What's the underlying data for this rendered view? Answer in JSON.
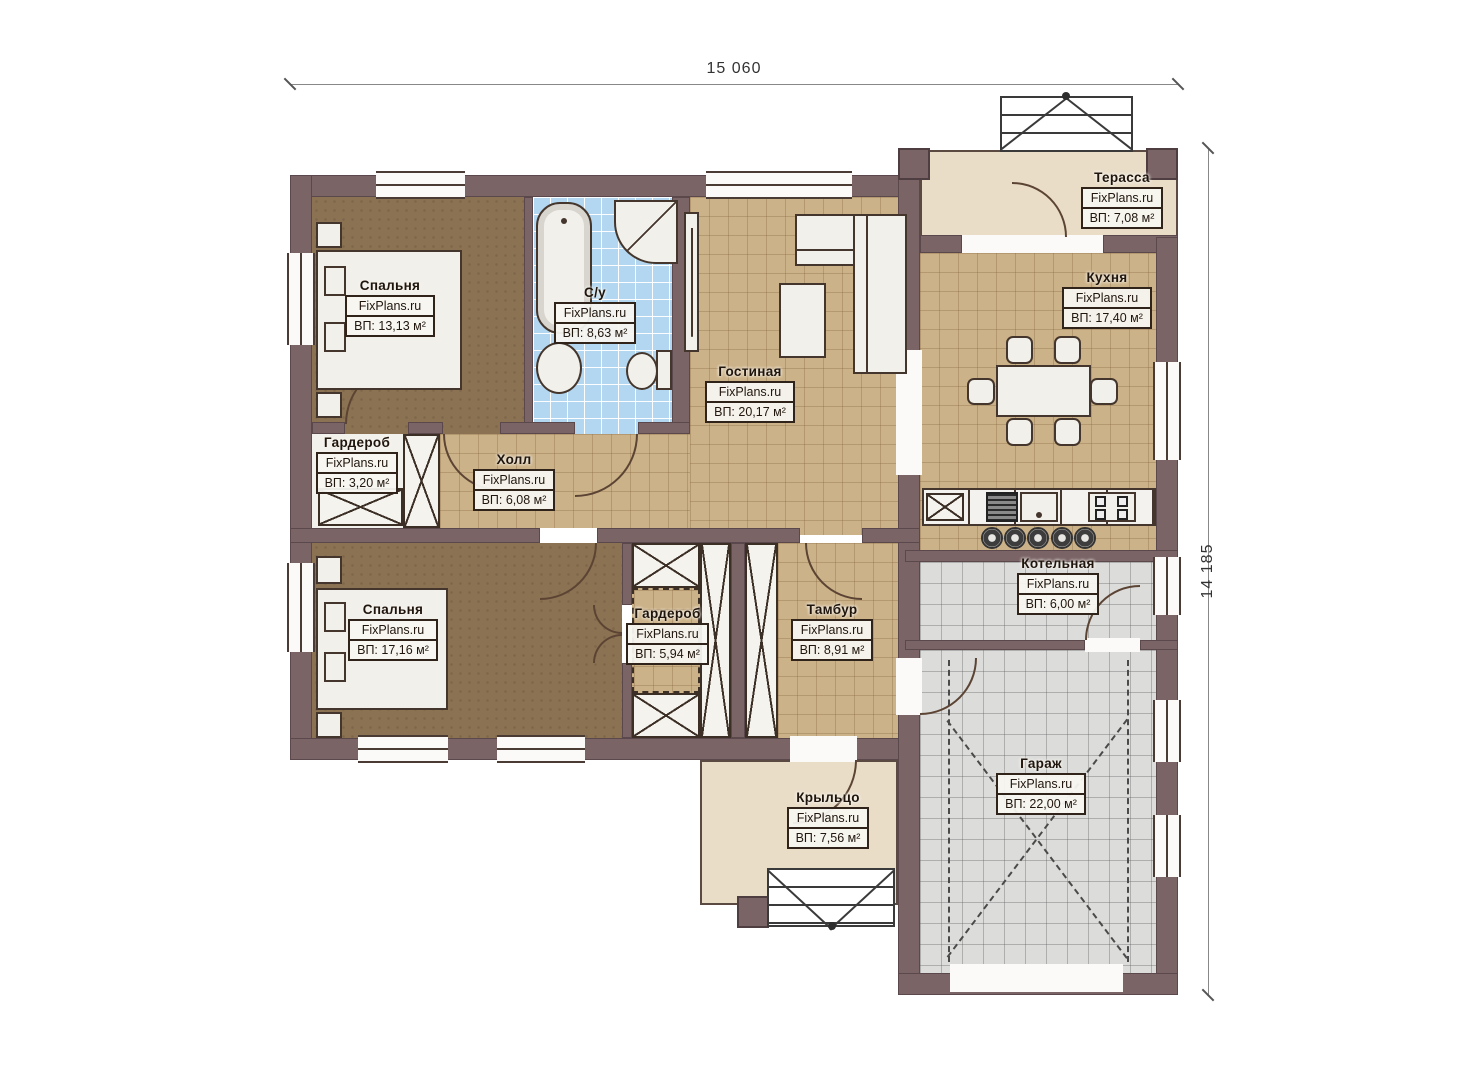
{
  "brand": "FixPlans.ru",
  "dimensions": {
    "width_label": "15 060",
    "height_label": "14 185"
  },
  "rooms": [
    {
      "id": "bedroom1",
      "name": "Спальня",
      "area": "ВП: 13,13 м²"
    },
    {
      "id": "bathroom",
      "name": "С/у",
      "area": "ВП: 8,63 м²"
    },
    {
      "id": "living",
      "name": "Гостиная",
      "area": "ВП: 20,17 м²"
    },
    {
      "id": "kitchen",
      "name": "Кухня",
      "area": "ВП: 17,40 м²"
    },
    {
      "id": "terrace",
      "name": "Терасса",
      "area": "ВП: 7,08 м²"
    },
    {
      "id": "wardrobe1",
      "name": "Гардероб",
      "area": "ВП: 3,20 м²"
    },
    {
      "id": "hall",
      "name": "Холл",
      "area": "ВП: 6,08 м²"
    },
    {
      "id": "bedroom2",
      "name": "Спальня",
      "area": "ВП: 17,16 м²"
    },
    {
      "id": "wardrobe2",
      "name": "Гардероб",
      "area": "ВП: 5,94 м²"
    },
    {
      "id": "tambour",
      "name": "Тамбур",
      "area": "ВП: 8,91 м²"
    },
    {
      "id": "boiler",
      "name": "Котельная",
      "area": "ВП: 6,00 м²"
    },
    {
      "id": "garage",
      "name": "Гараж",
      "area": "ВП: 22,00 м²"
    },
    {
      "id": "porch",
      "name": "Крыльцо",
      "area": "ВП: 7,56 м²"
    }
  ],
  "colors": {
    "wall": "#7b6466",
    "floor_wood": "#8b7252",
    "floor_tile_tan": "#ccb288",
    "floor_tile_blue": "#b3d6f1",
    "floor_tile_gray": "#dcdcda",
    "floor_terrace": "#e9ddc8",
    "label_border": "#30241a"
  }
}
